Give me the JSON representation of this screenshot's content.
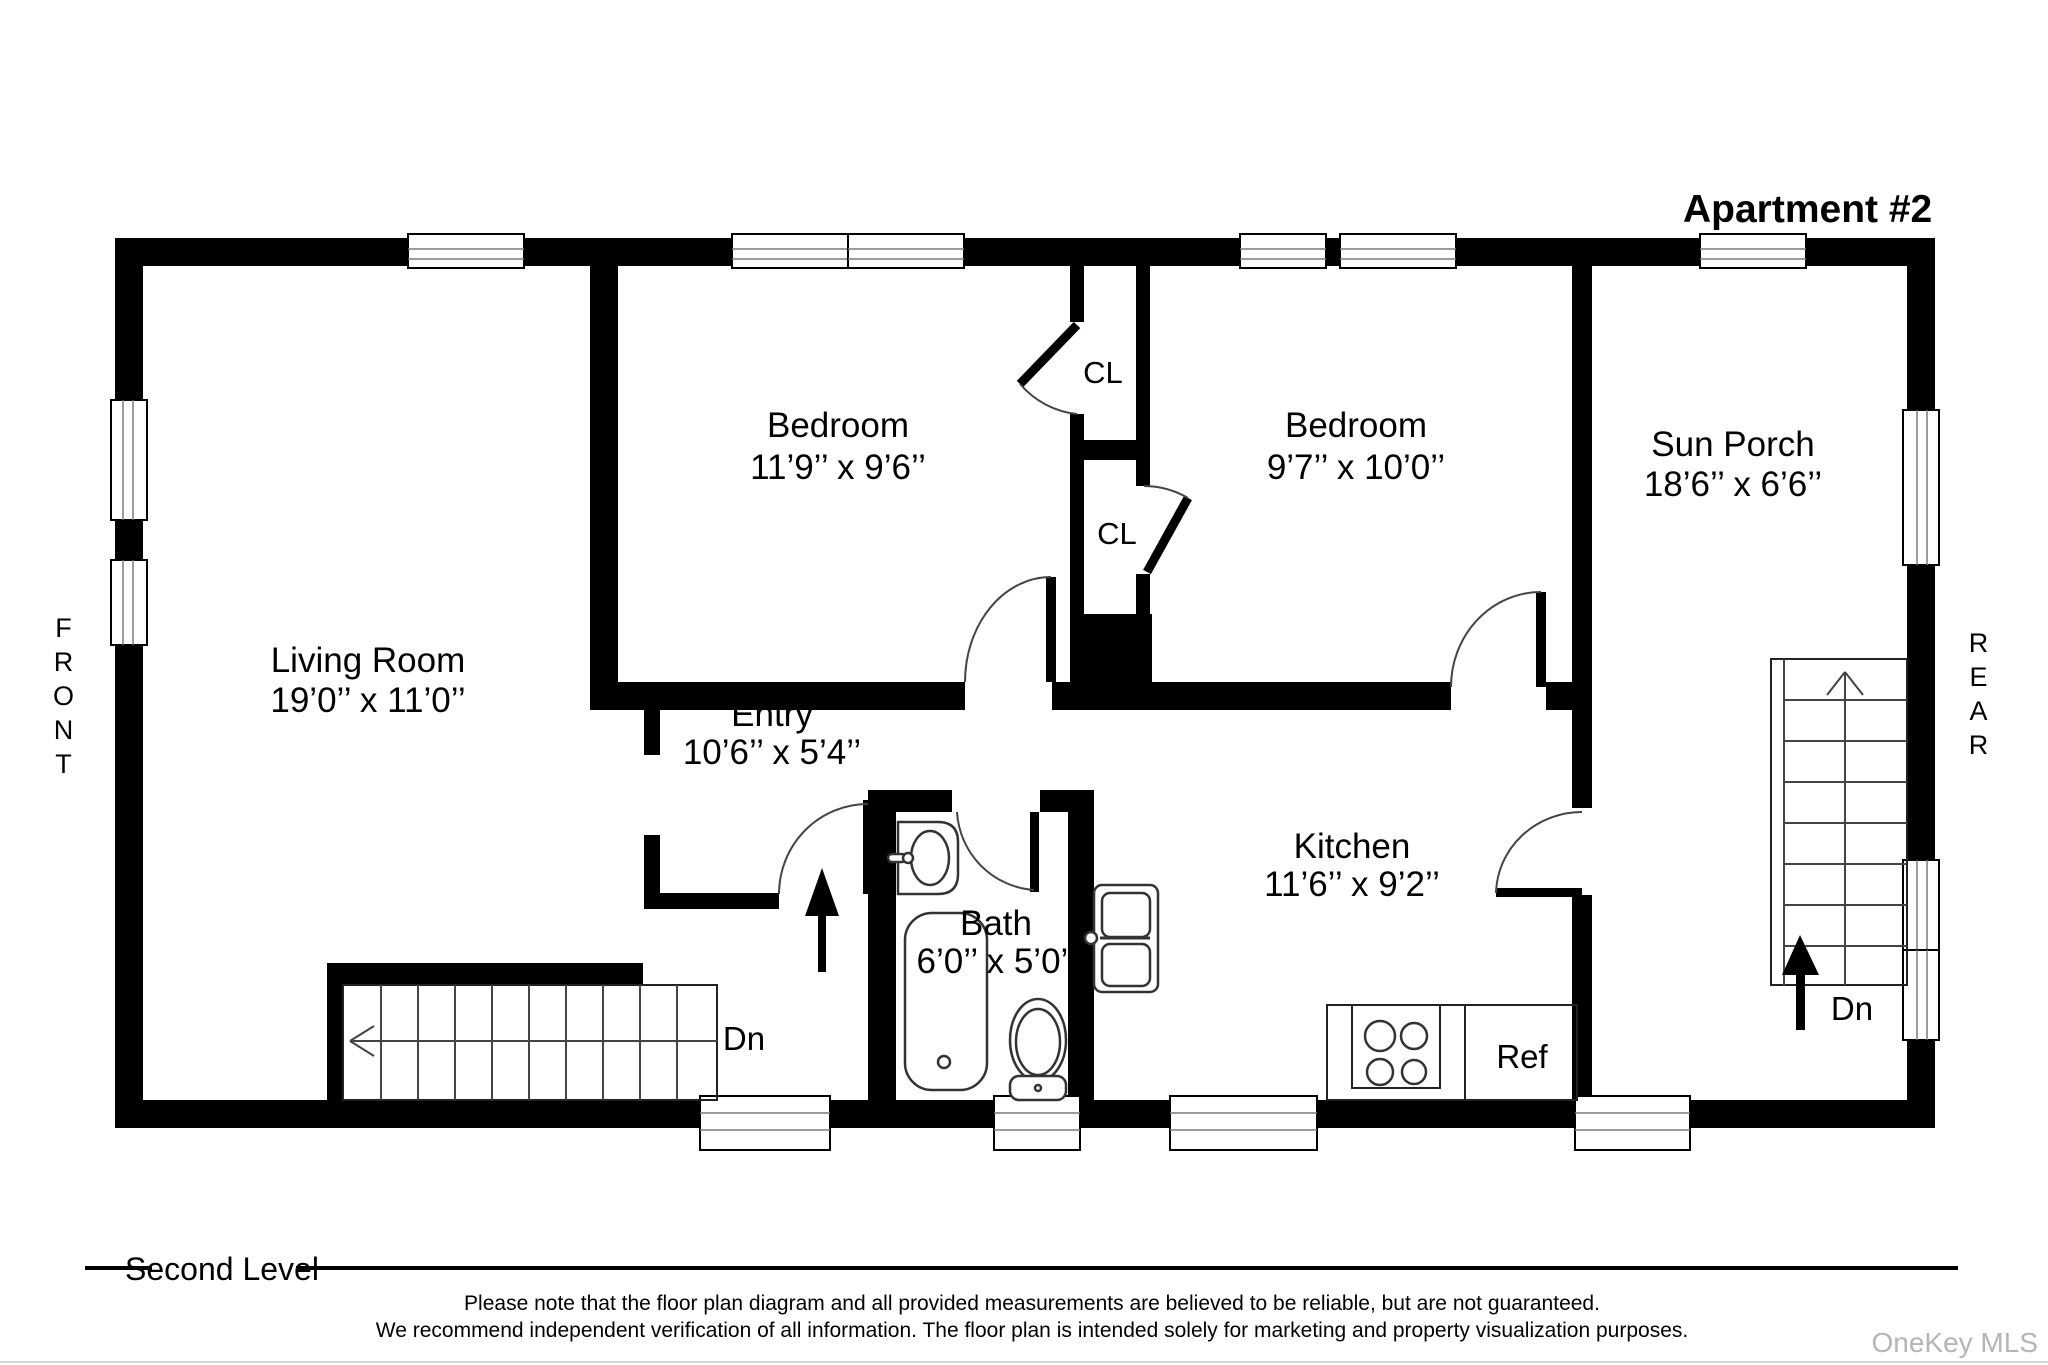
{
  "header": {
    "title": "Apartment #2"
  },
  "side_labels": {
    "front": "FRONT",
    "rear": "REAR"
  },
  "rooms": [
    {
      "id": "living-room",
      "name": "Living Room",
      "dims": "19’0’’ x 11’0’’"
    },
    {
      "id": "bedroom-1",
      "name": "Bedroom",
      "dims": "11’9’’ x 9’6’’"
    },
    {
      "id": "bedroom-2",
      "name": "Bedroom",
      "dims": "9’7’’ x 10’0’’"
    },
    {
      "id": "sun-porch",
      "name": "Sun Porch",
      "dims": "18’6’’ x 6’6’’"
    },
    {
      "id": "entry",
      "name": "Entry",
      "dims": "10’6’’ x 5’4’’"
    },
    {
      "id": "bath",
      "name": "Bath",
      "dims": "6’0’’ x 5’0’’"
    },
    {
      "id": "kitchen",
      "name": "Kitchen",
      "dims": "11’6’’ x 9’2’’"
    }
  ],
  "closets": {
    "cl1": "CL",
    "cl2": "CL"
  },
  "fixtures": {
    "ref": "Ref"
  },
  "stairs": {
    "dn_left": "Dn",
    "dn_right": "Dn"
  },
  "footer": {
    "level": "Second Level",
    "disclaimer_line1": "Please note that the floor plan diagram and all provided measurements are believed to be reliable, but are not guaranteed.",
    "disclaimer_line2": "We recommend independent verification of all information. The floor plan is intended solely for marketing and property visualization purposes.",
    "watermark": "OneKey MLS"
  },
  "colors": {
    "wall": "#000000",
    "background": "#ffffff",
    "window_line": "#7a7a7a",
    "watermark": "#b5b5b9"
  }
}
